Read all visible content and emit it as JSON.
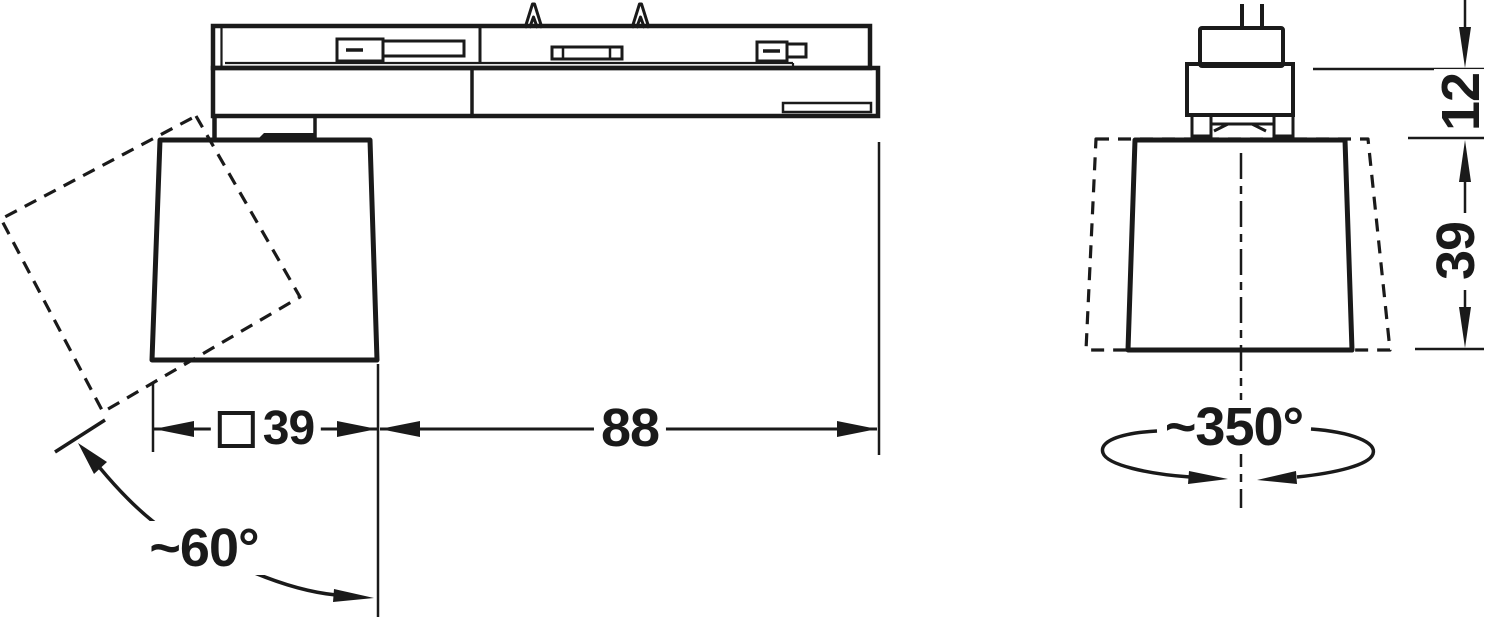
{
  "drawing_type": "technical dimension drawing, track-mounted swivel spotlight, side and front views",
  "colors": {
    "line": "#1a1a1a",
    "background": "#ffffff"
  },
  "dimensions": {
    "head_width": {
      "symbol": "□",
      "value": "39"
    },
    "arm_length": {
      "value": "88"
    },
    "adapter_offset": {
      "value": "12"
    },
    "head_height": {
      "value": "39"
    },
    "tilt_angle": {
      "value": "~60°"
    },
    "rotation_angle": {
      "value": "~350°"
    }
  }
}
